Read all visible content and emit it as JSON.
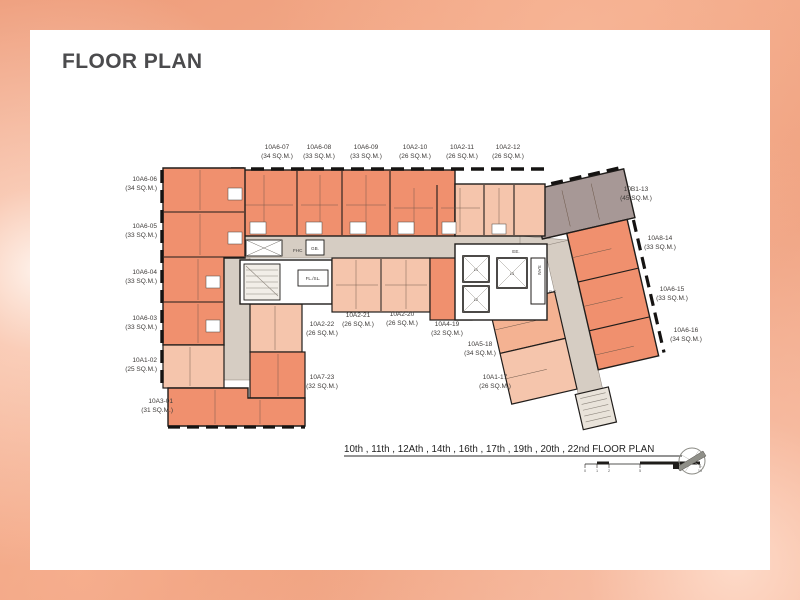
{
  "title": "FLOOR PLAN",
  "units": {
    "top": [
      {
        "id": "10A6-07",
        "area": "(34 SQ.M.)"
      },
      {
        "id": "10A6-08",
        "area": "(33 SQ.M.)"
      },
      {
        "id": "10A6-09",
        "area": "(33 SQ.M.)"
      },
      {
        "id": "10A2-10",
        "area": "(26 SQ.M.)"
      },
      {
        "id": "10A2-11",
        "area": "(26 SQ.M.)"
      },
      {
        "id": "10A2-12",
        "area": "(26 SQ.M.)"
      }
    ],
    "left": [
      {
        "id": "10A6-06",
        "area": "(34 SQ.M.)"
      },
      {
        "id": "10A6-05",
        "area": "(33 SQ.M.)"
      },
      {
        "id": "10A6-04",
        "area": "(33 SQ.M.)"
      },
      {
        "id": "10A6-03",
        "area": "(33 SQ.M.)"
      },
      {
        "id": "10A1-02",
        "area": "(25 SQ.M.)"
      },
      {
        "id": "10A3-01",
        "area": "(31 SQ.M.)"
      }
    ],
    "right": [
      {
        "id": "10B1-13",
        "area": "(45 SQ.M.)"
      },
      {
        "id": "10A8-14",
        "area": "(33 SQ.M.)"
      },
      {
        "id": "10A6-15",
        "area": "(33 SQ.M.)"
      },
      {
        "id": "10A6-16",
        "area": "(34 SQ.M.)"
      }
    ],
    "bottom": [
      {
        "id": "10A2-22",
        "area": "(26 SQ.M.)"
      },
      {
        "id": "10A2-21",
        "area": "(26 SQ.M.)"
      },
      {
        "id": "10A2-20",
        "area": "(26 SQ.M.)"
      },
      {
        "id": "10A4-19",
        "area": "(32 SQ.M.)"
      },
      {
        "id": "10A5-18",
        "area": "(34 SQ.M.)"
      },
      {
        "id": "10A7-23",
        "area": "(32 SQ.M.)"
      },
      {
        "id": "10A1-17",
        "area": "(26 SQ.M.)"
      }
    ]
  },
  "core": {
    "fhc_left": "FHC",
    "gb": "GB.",
    "fl_sl": "FL./SL.",
    "ee": "EE.",
    "san": "SAN",
    "fhc_right": "FHC",
    "lifts": [
      "L1",
      "L2",
      "L3"
    ]
  },
  "caption": {
    "floors": "10th , 11th , 12Ath , 14th , 16th , 17th , 19th , 20th , 22nd ",
    "suffix": "FLOOR PLAN"
  },
  "scale_bar": {
    "ticks": [
      "0",
      "1",
      "2",
      "5",
      "10"
    ]
  },
  "colors": {
    "unit_salmon": "#F0906E",
    "unit_light": "#F5C5AC",
    "unit_gray": "#A79896",
    "corridor": "#D6CDC3",
    "wall": "#201D1B",
    "background_peach": "#F3AB8A"
  }
}
